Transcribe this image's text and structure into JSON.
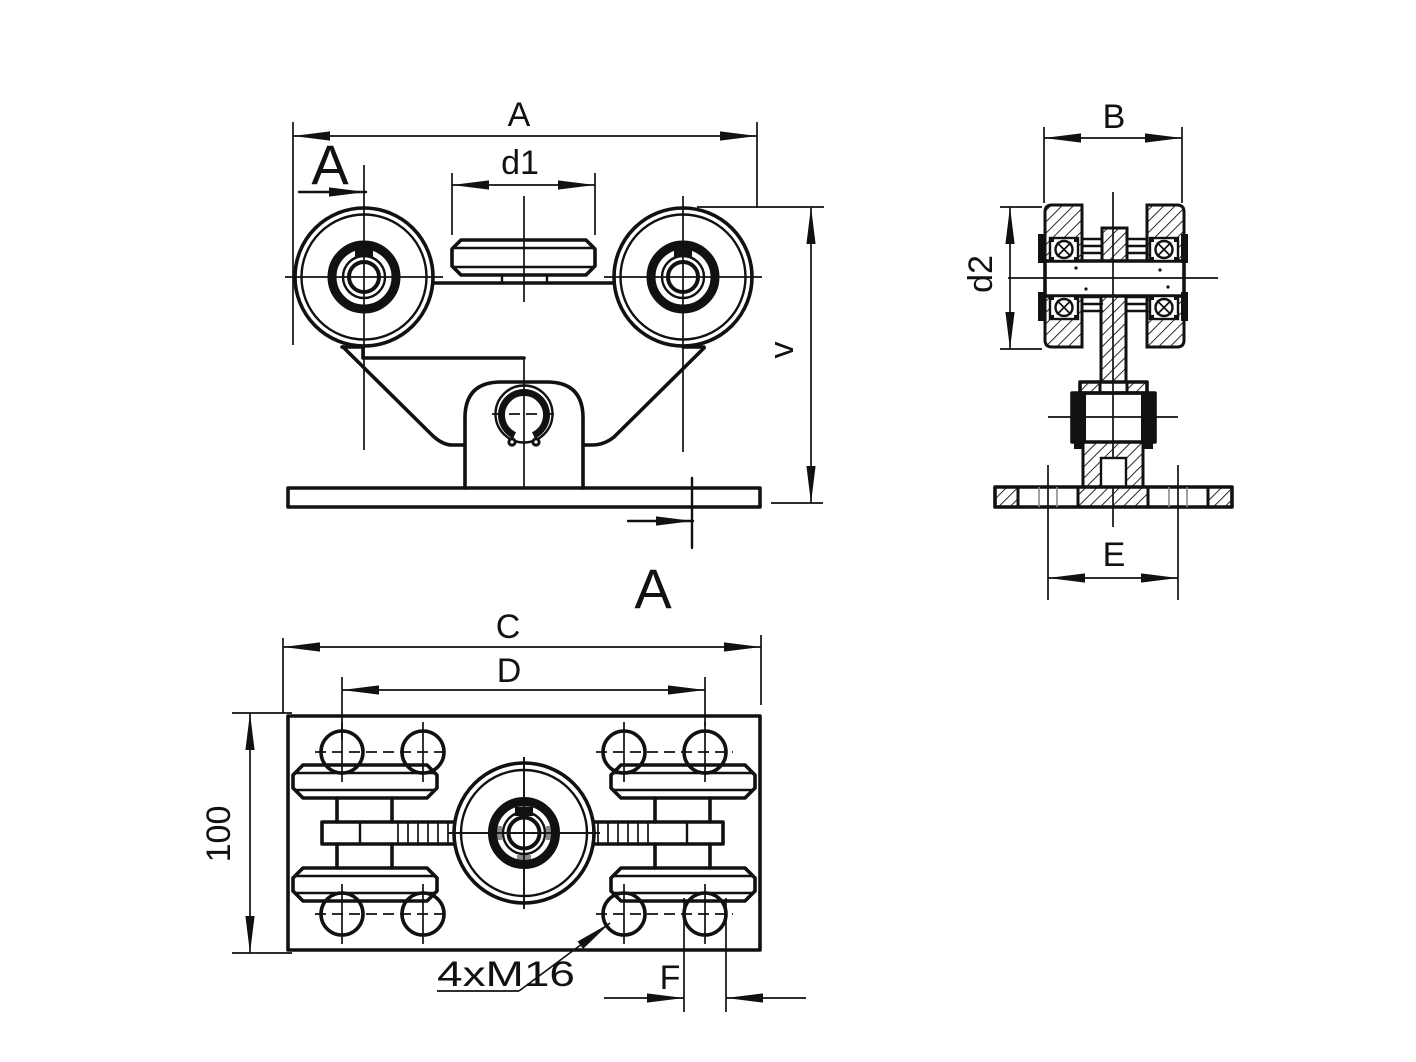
{
  "page": {
    "background_color": "#ffffff",
    "line_color": "#111111",
    "accent_gray": "#8a8a8a",
    "type": "technical-drawing"
  },
  "labels": {
    "dim_A": "A",
    "dim_d1": "d1",
    "dim_v": "v",
    "dim_B": "B",
    "dim_d2": "d2",
    "dim_E": "E",
    "dim_C": "C",
    "dim_D": "D",
    "dim_100": "100",
    "dim_F": "F",
    "note_bolts": "4xM16",
    "section_mark_top": "A",
    "section_mark_bottom": "A"
  }
}
